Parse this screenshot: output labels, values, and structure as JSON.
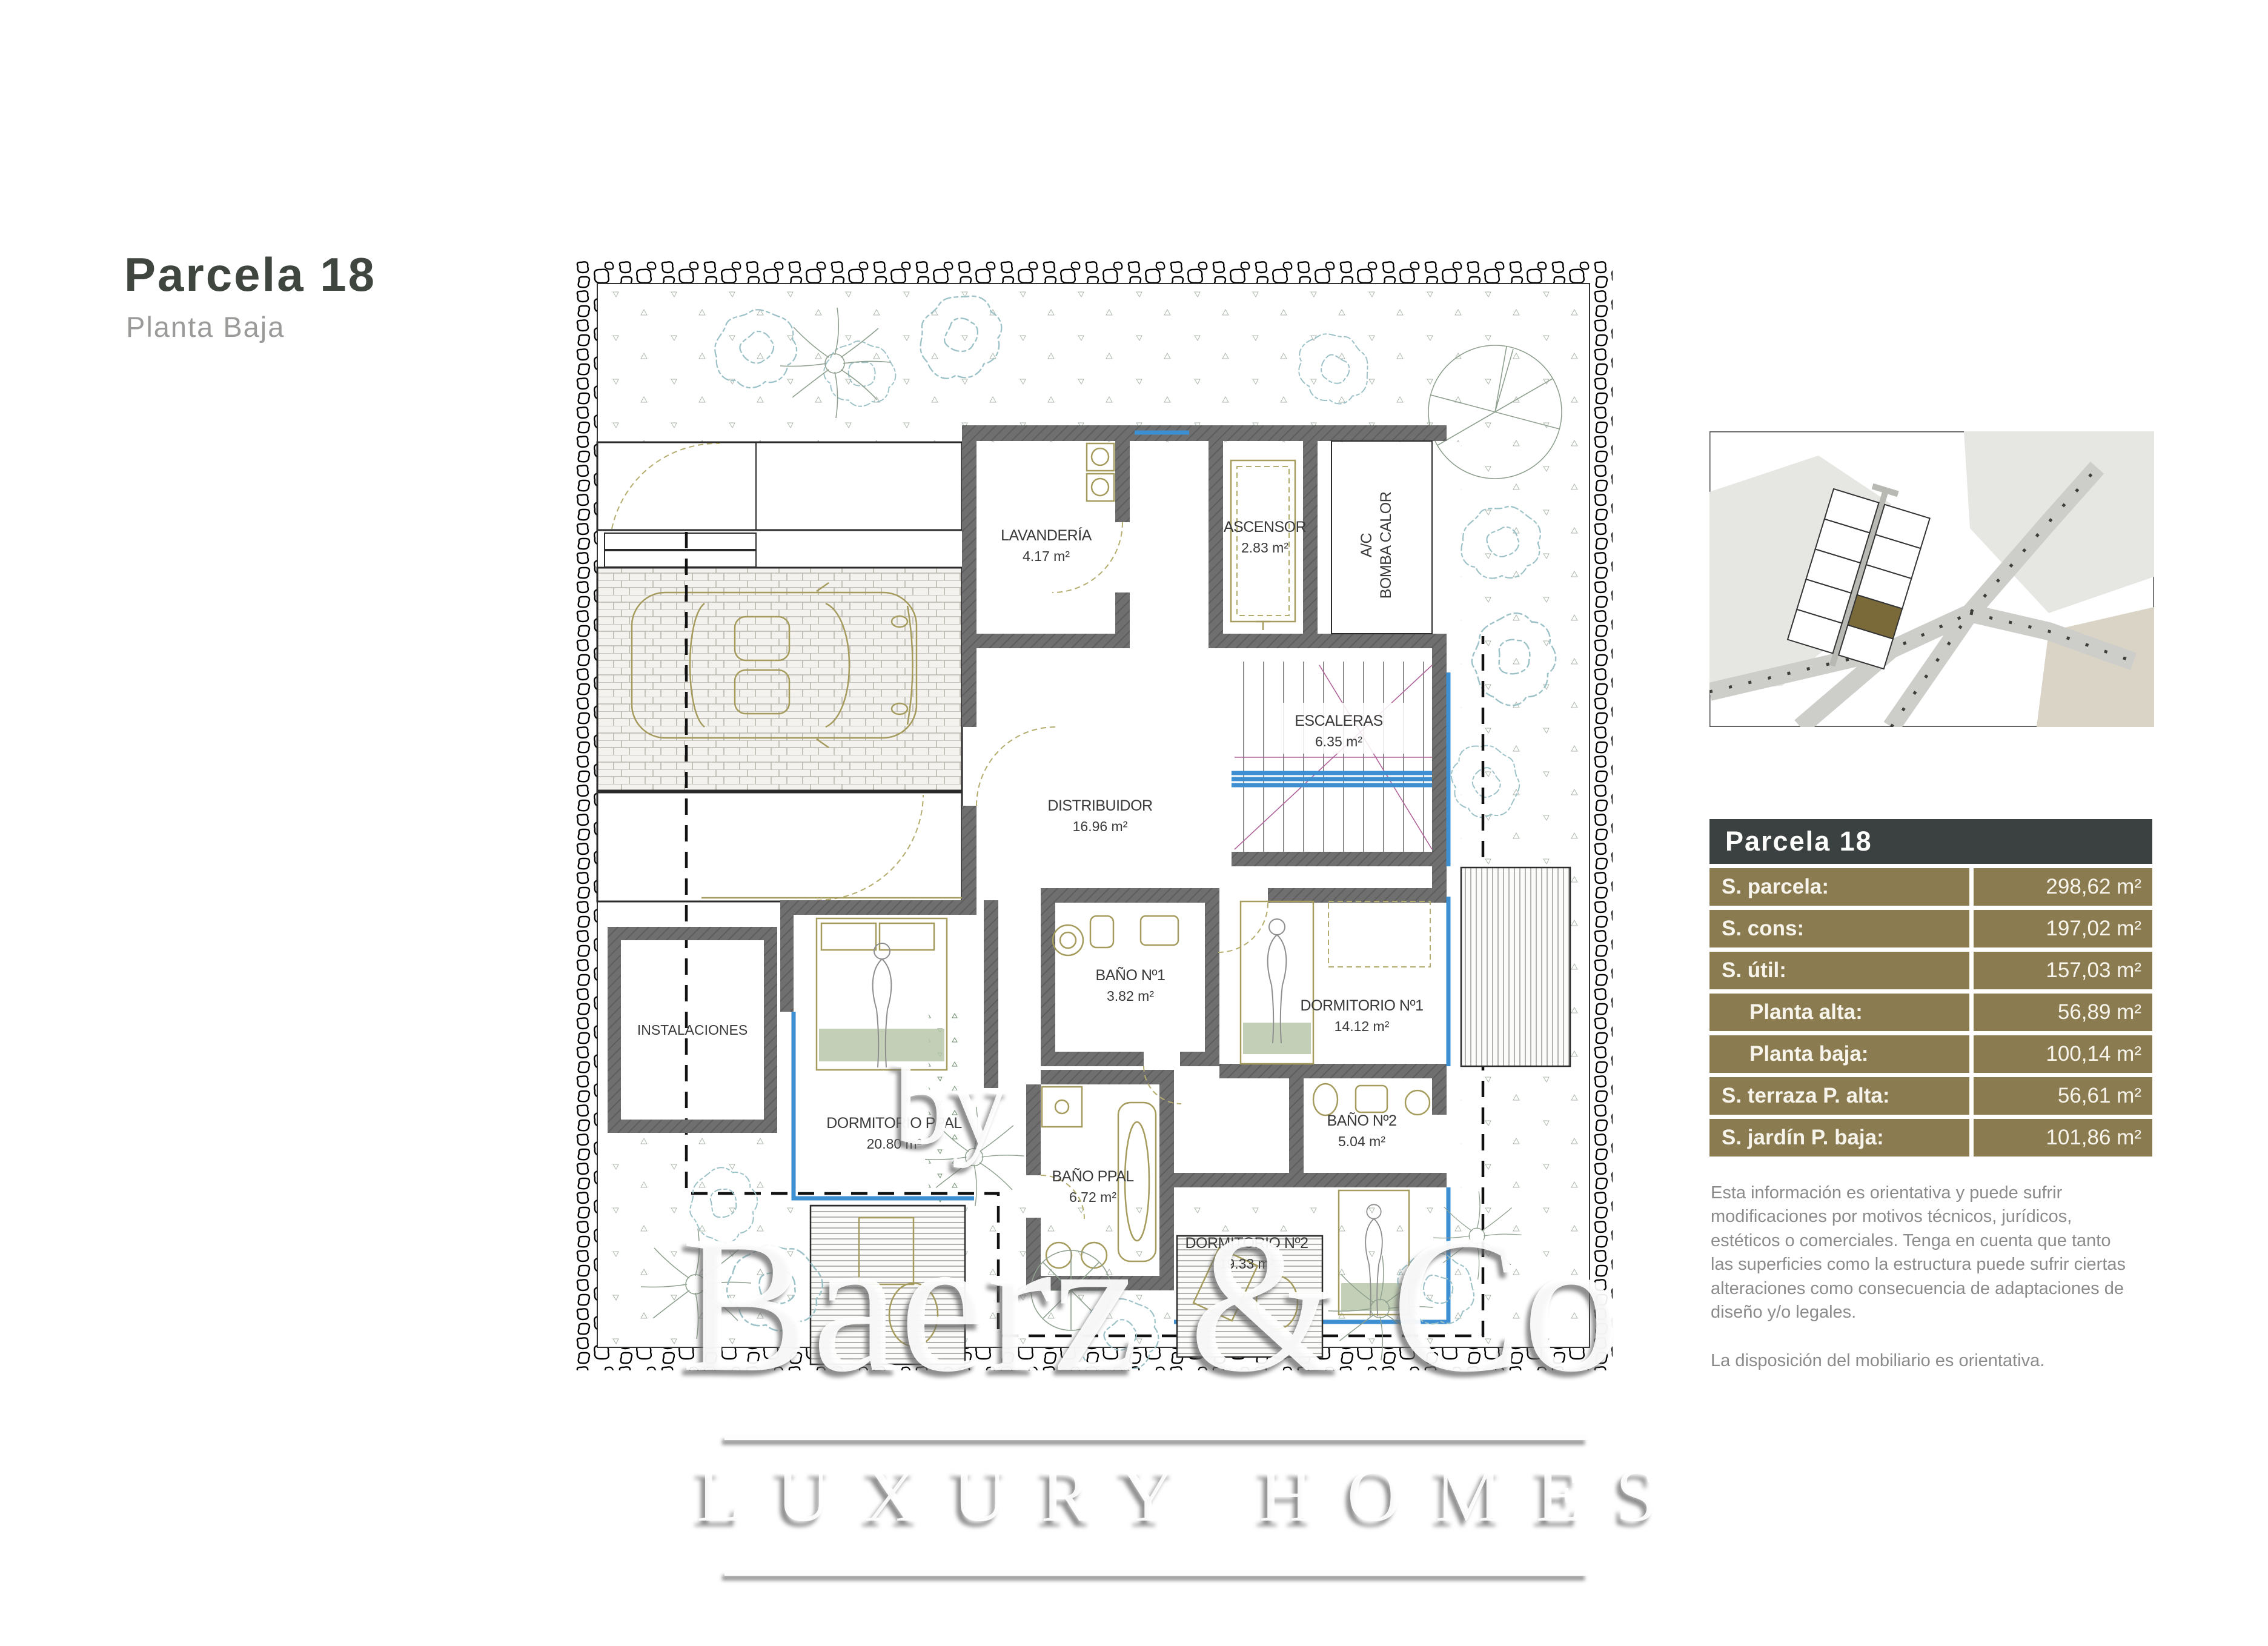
{
  "page": {
    "title": "Parcela 18",
    "subtitle": "Planta Baja"
  },
  "plan": {
    "rooms": {
      "lavanderia": {
        "name": "LAVANDERÍA",
        "area": "4.17 m²"
      },
      "ascensor": {
        "name": "ASCENSOR",
        "area": "2.83 m²"
      },
      "ac_bomba": {
        "line1": "A/C",
        "line2": "BOMBA CALOR"
      },
      "escaleras": {
        "name": "ESCALERAS",
        "area": "6.35 m²"
      },
      "distribuidor": {
        "name": "DISTRIBUIDOR",
        "area": "16.96 m²"
      },
      "bano1": {
        "name": "BAÑO Nº1",
        "area": "3.82 m²"
      },
      "dormitorio1": {
        "name": "DORMITORIO Nº1",
        "area": "14.12 m²"
      },
      "bano2": {
        "name": "BAÑO Nº2",
        "area": "5.04 m²"
      },
      "instalaciones": {
        "name": "INSTALACIONES"
      },
      "dormitorio_ppal": {
        "name": "DORMITORIO PPAL",
        "area": "20.80 m²"
      },
      "bano_ppal": {
        "name": "BAÑO PPAL",
        "area": "6.72 m²"
      },
      "dormitorio2": {
        "name": "DORMITORIO Nº2",
        "area": "19.33 m²"
      }
    }
  },
  "summary_table": {
    "header": "Parcela 18",
    "rows": [
      {
        "label": "S. parcela:",
        "value": "298,62 m²"
      },
      {
        "label": "S. cons:",
        "value": "197,02 m²"
      },
      {
        "label": "S. útil:",
        "value": "157,03 m²"
      },
      {
        "label": "Planta alta:",
        "value": "56,89 m²"
      },
      {
        "label": "Planta baja:",
        "value": "100,14 m²"
      },
      {
        "label": "S. terraza P. alta:",
        "value": "56,61 m²"
      },
      {
        "label": "S. jardín P. baja:",
        "value": "101,86 m²"
      }
    ],
    "colors": {
      "header_bg": "#3A4140",
      "row_bg": "#8B7B51",
      "text": "#F7F4EC"
    }
  },
  "disclaimer": {
    "paragraph1": "Esta información es orientativa y puede sufrir modificaciones por motivos técnicos, jurídicos, estéticos o comerciales. Tenga en cuenta que tanto las superficies como la estructura puede sufrir ciertas alteraciones como consecuencia de adaptaciones de diseño y/o legales.",
    "paragraph2": "La disposición del mobiliario es orientativa."
  },
  "watermark": {
    "by": "by",
    "brand": "Baerz & Co",
    "tagline": "LUXURY HOMES"
  },
  "colors": {
    "accent_olive": "#8B7B51",
    "header_slate": "#3A4140",
    "glazing_blue": "#3D8FD2",
    "lot_highlight": "#7A6A3A"
  }
}
